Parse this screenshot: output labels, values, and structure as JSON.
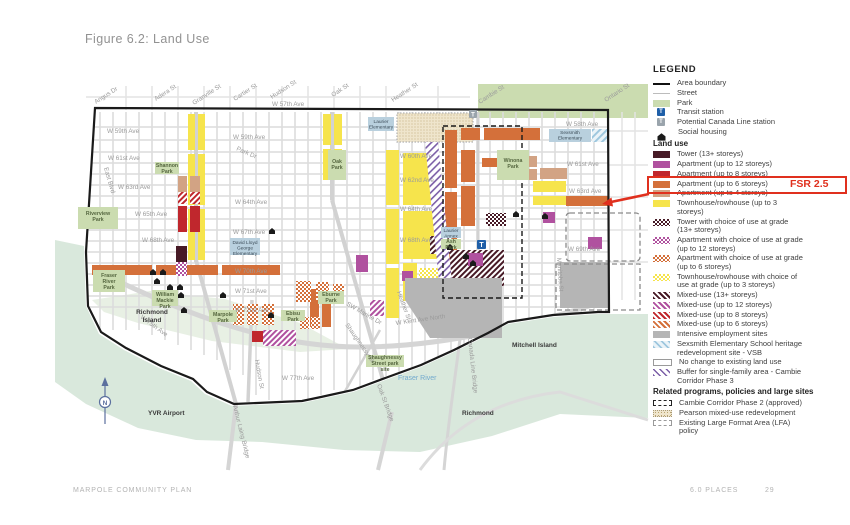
{
  "page": {
    "title": "Figure 6.2: Land Use",
    "footer_left": "MARPOLE COMMUNITY PLAN",
    "footer_section": "6.0 PLACES",
    "footer_page": "29"
  },
  "annotation": {
    "fsr_label": "FSR 2.5"
  },
  "legend": {
    "title": "LEGEND",
    "general": [
      {
        "label": "Area boundary",
        "type": "line-black"
      },
      {
        "label": "Street",
        "type": "line-gray"
      },
      {
        "label": "Park",
        "type": "park-fill"
      },
      {
        "label": "Transit station",
        "type": "transit-station-icon",
        "glyph": "T"
      },
      {
        "label": "Potential Canada Line station",
        "type": "potential-station-icon",
        "glyph": "T"
      },
      {
        "label": "Social housing",
        "type": "social-housing-icon"
      }
    ],
    "land_use_header": "Land use",
    "land_use": [
      {
        "label": "Tower (13+ storeys)",
        "type": "maroon"
      },
      {
        "label": "Apartment (up to 12 storeys)",
        "type": "purple"
      },
      {
        "label": "Apartment (up to 8 storeys)",
        "type": "red"
      },
      {
        "label": "Apartment (up to 6 storeys)",
        "type": "orange"
      },
      {
        "label": "Apartment (up to 4 storeys)",
        "type": "tan"
      },
      {
        "label": "Townhouse/rowhouse (up to 3 storeys)",
        "type": "yellow"
      },
      {
        "label": "Tower with choice of use at grade (13+ storeys)",
        "type": "check-maroon"
      },
      {
        "label": "Apartment with choice of use at grade (up to 12 storeys)",
        "type": "check-purple"
      },
      {
        "label": "Apartment with choice of use at grade (up to 6 storeys)",
        "type": "check-orange"
      },
      {
        "label": "Townhouse/rowhouse with choice of use at grade (up to 3 storeys)",
        "type": "check-yellow"
      },
      {
        "label": "Mixed-use (13+ storeys)",
        "type": "stripe-maroon"
      },
      {
        "label": "Mixed-use (up to 12 storeys)",
        "type": "stripe-purple"
      },
      {
        "label": "Mixed-use (up to 8 storeys)",
        "type": "stripe-red"
      },
      {
        "label": "Mixed-use (up to 6 storeys)",
        "type": "stripe-orange"
      },
      {
        "label": "Intensive employment sites",
        "type": "gray"
      },
      {
        "label": "Sexsmith Elementary School heritage redevelopment site - VSB",
        "type": "hatch-blue"
      },
      {
        "label": "No change to existing land use",
        "type": "no-change"
      },
      {
        "label": "Buffer for single-family area - Cambie Corridor Phase 3",
        "type": "buffer-hatch"
      }
    ],
    "related_header": "Related programs, policies and large sites",
    "related": [
      {
        "label": "Cambie Corridor Phase 2 (approved)",
        "type": "dashed-black"
      },
      {
        "label": "Pearson mixed-use redevelopment",
        "type": "stipple"
      },
      {
        "label": "Existing Large Format Area (LFA) policy",
        "type": "dashed-gray"
      }
    ]
  },
  "map": {
    "transit_glyph": "T",
    "labels": {
      "w57": "W 57th Ave",
      "w58": "W 58th Ave",
      "w59a": "W 59th Ave",
      "w59b": "W 59th Ave",
      "w60": "W 60th Ave",
      "w61a": "W 61st Ave",
      "w61b": "W 61st Ave",
      "w62": "W 62nd Ave",
      "w63a": "W 63rd Ave",
      "w63b": "W 63rd Ave",
      "w64a": "W 64th Ave",
      "w64b": "W 64th Ave",
      "w65": "W 65th Ave",
      "w67": "W 67th Ave",
      "w68a": "W 68th Ave",
      "w68b": "W 68th Ave",
      "w69": "W 69th Ave",
      "w70": "W 70th Ave",
      "w71": "W 71st Ave",
      "w72": "W 72nd Ave",
      "w75": "W 75th Ave",
      "w77": "W 77th Ave",
      "angus": "Angus Dr",
      "adera": "Adera St",
      "granville": "Granville St",
      "cartier": "Cartier St",
      "hudson_n": "Hudson St",
      "oak": "Oak St",
      "heather_n": "Heather St",
      "cambie": "Cambie St",
      "ontario": "Ontario St",
      "east_blvd": "East Blvd",
      "park_dr": "Park Dr",
      "hudson_s": "Hudson St",
      "manitoba": "Manitoba St",
      "shaughnessy": "Shaughnessy St",
      "sw_marine": "SW Marine Dr",
      "kent": "W Kent Ave North",
      "heather_s": "Heather St",
      "oak_bridge": "Oak St Bridge",
      "canada_bridge": "Canada Line Bridge",
      "laing_bridge": "Arthur Laing Bridge",
      "fraser_river": "Fraser River",
      "richmond_island": [
        "Richmond",
        "Island"
      ],
      "mitchell_island": "Mitchell Island",
      "richmond": "Richmond",
      "yvr": "YVR Airport",
      "north": "N"
    },
    "parks": {
      "oak_park": [
        "Oak",
        "Park"
      ],
      "winona": [
        "Winona",
        "Park"
      ],
      "shannon": [
        "Shannon",
        "Park"
      ],
      "riverview": [
        "Riverview",
        "Park"
      ],
      "fraser_river_park": [
        "Fraser",
        "River",
        "Park"
      ],
      "mackie": [
        "William",
        "Mackie",
        "Park"
      ],
      "marpole": [
        "Marpole",
        "Park"
      ],
      "eburne": [
        "Eburne",
        "Park"
      ],
      "ebisu": [
        "Ebisu",
        "Park"
      ],
      "ash": [
        "Ash",
        "Park"
      ],
      "shaughnessy_site": [
        "Shaughnessy",
        "Street park",
        "site"
      ]
    },
    "schools": {
      "laurier": [
        "Laurier",
        "Elementary"
      ],
      "sexsmith": [
        "Sexsmith",
        "Elementary"
      ],
      "laurier_annex": [
        "Laurier",
        "Annex"
      ],
      "dlg": [
        "David Lloyd",
        "George",
        "Elementary"
      ]
    }
  },
  "colors": {
    "annotation_red": "#e0301e",
    "park": "#cbdcb0",
    "water": "#d9e8dc",
    "street": "#dcdcdc",
    "tower": "#471a26",
    "apartment_12": "#b0519f",
    "apartment_8": "#c0272d",
    "apartment_6": "#d4703a",
    "apartment_4": "#d2a384",
    "townhouse": "#f6e44c",
    "employment": "#b5b5b5",
    "school": "#b9d0de",
    "transit": "#1f5fa8",
    "buffer": "#7b5ea7",
    "sexsmith_hatch": "#9ec7de",
    "pearson": "#efe5cc"
  }
}
